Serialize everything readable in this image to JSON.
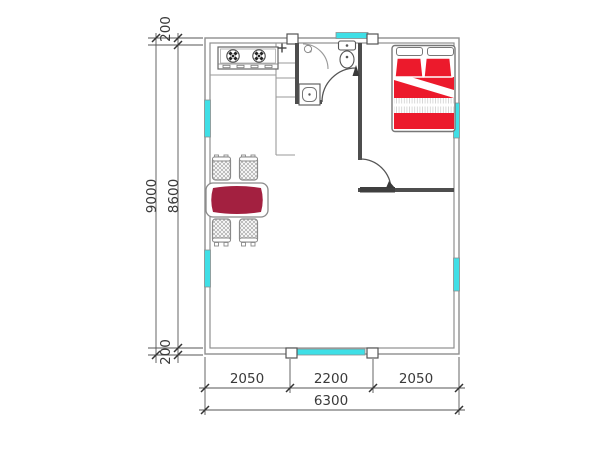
{
  "title": "apartment-floor-plan",
  "dimensions": {
    "left": {
      "overall": "9000",
      "interior": "8600",
      "wall_top": "200",
      "wall_bottom": "200"
    },
    "bottom": {
      "segment_left": "2050",
      "segment_middle": "2200",
      "segment_right": "2050",
      "overall": "6300"
    }
  },
  "colors": {
    "window": "#3fdfe6",
    "bed": "#ec1a2c",
    "table": "#a32040",
    "wall_outer": "#8f8f8f",
    "wall_interior": "#4d4d4d",
    "dimension_text": "#3a3a3a"
  },
  "fixtures": {
    "stove": "two-burner-stove-icon",
    "kitchen_faucet": "faucet-cross-icon",
    "toilet": "toilet-icon",
    "bathroom_sink": "washbasin-icon",
    "floor_drain": "floor-drain-icon",
    "shower_door": "quarter-arc-door-icon",
    "bed": "double-bed-icon",
    "dining_table": "dining-table-icon",
    "chair": "chair-icon",
    "window": "window-glazing-icon",
    "door_swing": "door-swing-arc-icon"
  }
}
